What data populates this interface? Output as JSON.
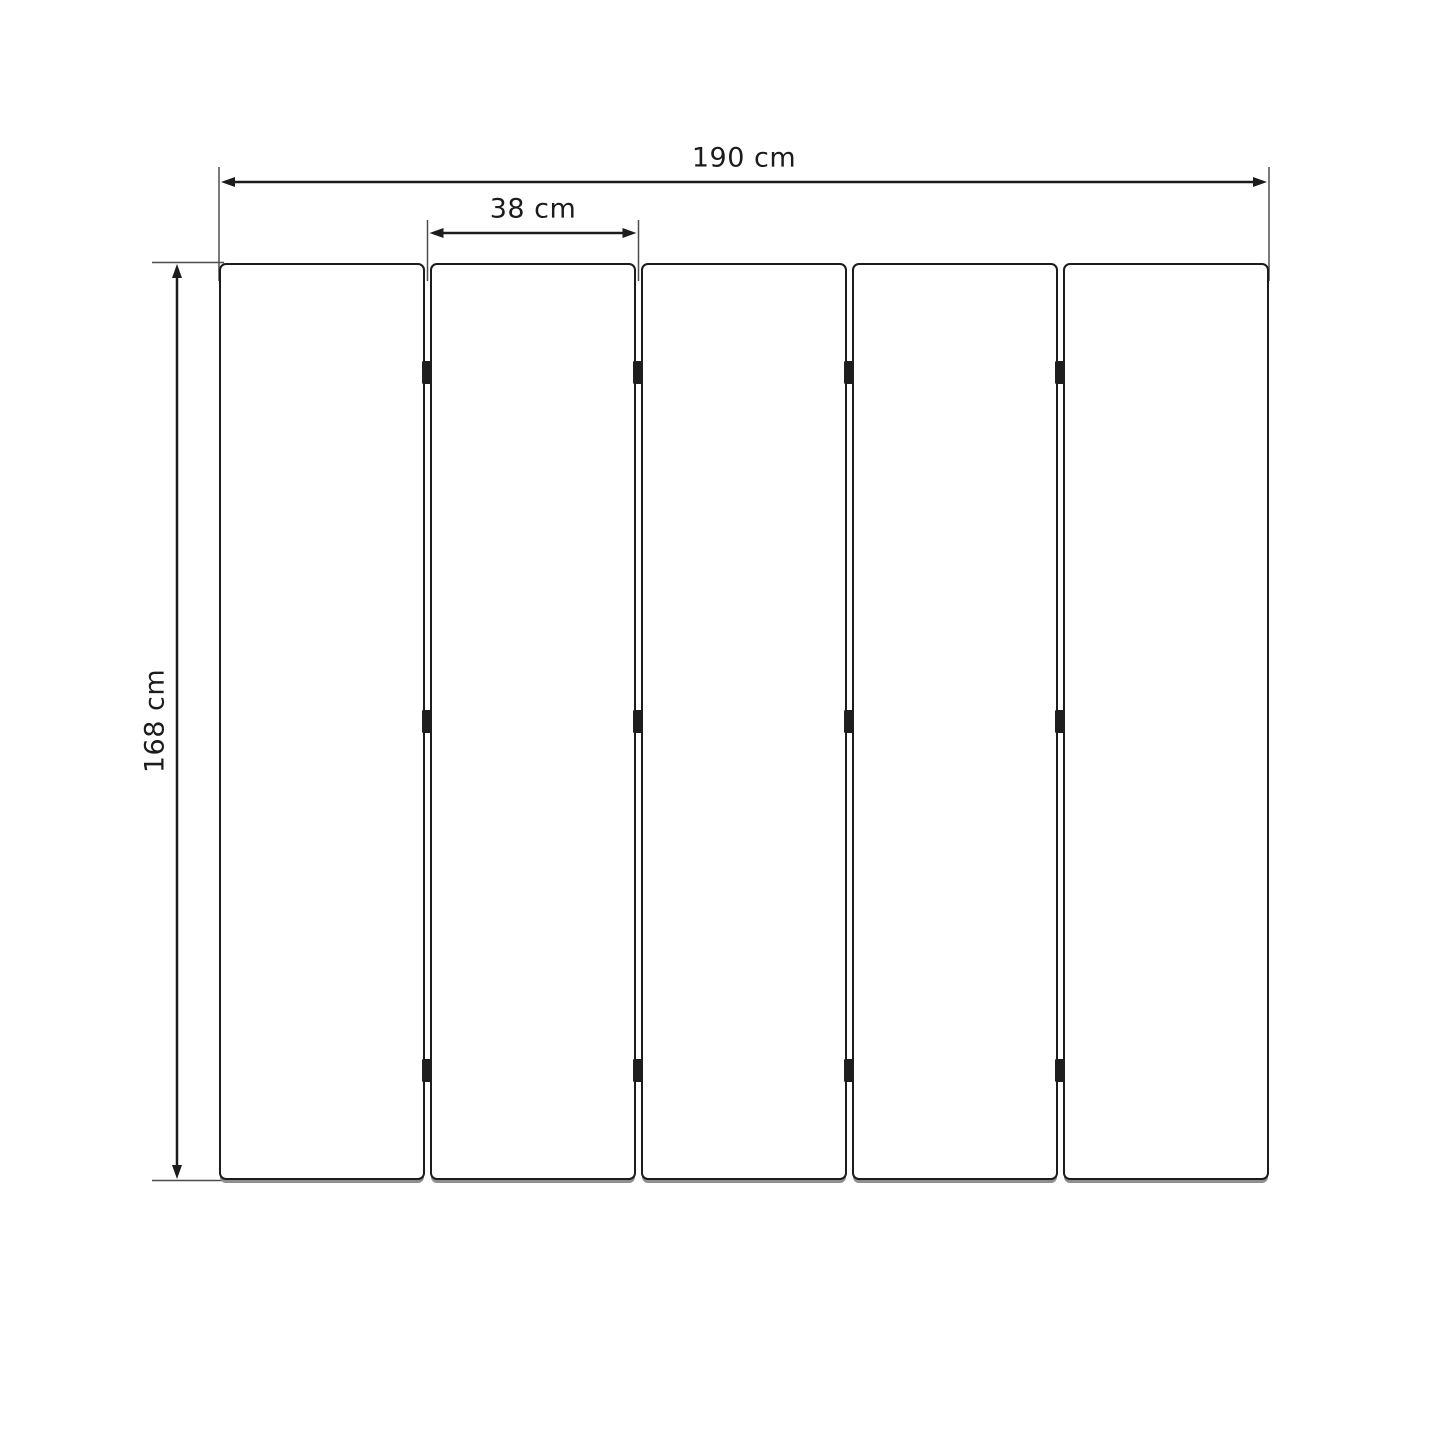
{
  "page": {
    "background_color": "#ffffff"
  },
  "diagram": {
    "type": "dimensioned technical drawing",
    "subject": "folding screen of vertical panels with hinges",
    "panel_count": 5,
    "gap_count": 4,
    "hinges_per_gap": 3,
    "labels": {
      "total_width": "190 cm",
      "single_panel_width": "38 cm",
      "height": "168 cm"
    },
    "colors": {
      "line": "#1c1c1c",
      "extension_line": "#4d4d4d",
      "panel_fill": "#ffffff",
      "panel_outline": "#1c1c1c",
      "panel_shadow": "#8f8f8f",
      "hinge": "#1e1e1e",
      "text": "#1c1c1c"
    }
  }
}
